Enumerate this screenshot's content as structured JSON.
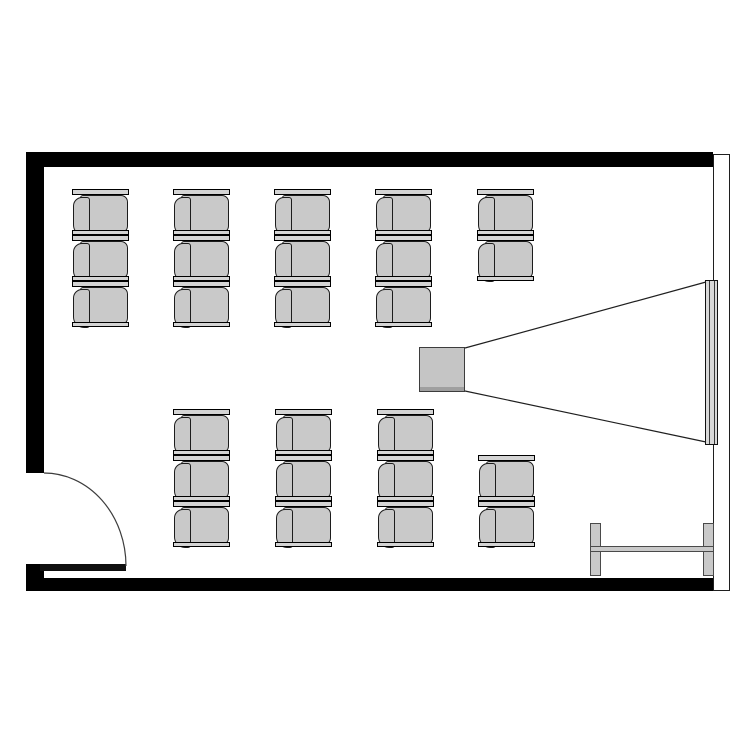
{
  "meta": {
    "title": "Classroom floor plan",
    "diagram_type": "floor-plan",
    "description": "Top-down room plan with two blocks of chairs facing a projector and wall screen, entry door at bottom-left, side table at bottom-right",
    "text_labels": []
  },
  "canvas": {
    "width": 750,
    "height": 750
  },
  "colors": {
    "background": "#ffffff",
    "wall": "#000000",
    "line": "#1f1f1f",
    "chair_seat": "#c9c9c9",
    "chair_bar": "#d4d4d4",
    "projector": "#c5c5c5",
    "screen": "#d9d9d9",
    "table": "#c9c9c9",
    "table_border": "#4a4a4a"
  },
  "walls": {
    "top": {
      "x": 26,
      "y": 152,
      "w": 687,
      "h": 15
    },
    "left_upper": {
      "x": 26,
      "y": 152,
      "w": 18,
      "h": 321
    },
    "left_lower": {
      "x": 26,
      "y": 564,
      "w": 18,
      "h": 27
    },
    "bottom": {
      "x": 26,
      "y": 578,
      "w": 687,
      "h": 13
    },
    "right": {
      "x": 713,
      "y": 154,
      "w": 17,
      "h": 437
    }
  },
  "door": {
    "opening": {
      "x": 26,
      "y": 473,
      "w": 18,
      "h": 91
    },
    "leaf": {
      "x": 40,
      "y": 564,
      "w": 86,
      "h": 7
    },
    "arc_path": "M 44 473 A 82 93 0 0 1 126 566"
  },
  "chairs": {
    "total": 25,
    "unit_size": {
      "w": 57,
      "h": 47
    },
    "groups": [
      {
        "name": "front-block",
        "positions": [
          [
            72,
            189
          ],
          [
            173,
            189
          ],
          [
            274,
            189
          ],
          [
            375,
            189
          ],
          [
            477,
            189
          ],
          [
            72,
            235
          ],
          [
            173,
            235
          ],
          [
            274,
            235
          ],
          [
            375,
            235
          ],
          [
            477,
            235
          ],
          [
            72,
            281
          ],
          [
            173,
            281
          ],
          [
            274,
            281
          ],
          [
            375,
            281
          ]
        ]
      },
      {
        "name": "back-block",
        "positions": [
          [
            173,
            409
          ],
          [
            275,
            409
          ],
          [
            377,
            409
          ],
          [
            173,
            455
          ],
          [
            275,
            455
          ],
          [
            377,
            455
          ],
          [
            478,
            455
          ],
          [
            173,
            501
          ],
          [
            275,
            501
          ],
          [
            377,
            501
          ],
          [
            478,
            501
          ]
        ]
      }
    ]
  },
  "projector": {
    "x": 419,
    "y": 347,
    "w": 46,
    "h": 45
  },
  "screen": {
    "x": 705,
    "y": 280,
    "w": 13,
    "h": 165
  },
  "cone": {
    "top_line": [
      465,
      348,
      706,
      282
    ],
    "bottom_line": [
      465,
      391,
      706,
      442
    ]
  },
  "table": {
    "left_cap": {
      "x": 590,
      "y": 523,
      "w": 11,
      "h": 53
    },
    "right_cap": {
      "x": 703,
      "y": 523,
      "w": 11,
      "h": 53
    },
    "rail": {
      "x": 590,
      "y": 546,
      "w": 124,
      "h": 6
    }
  }
}
